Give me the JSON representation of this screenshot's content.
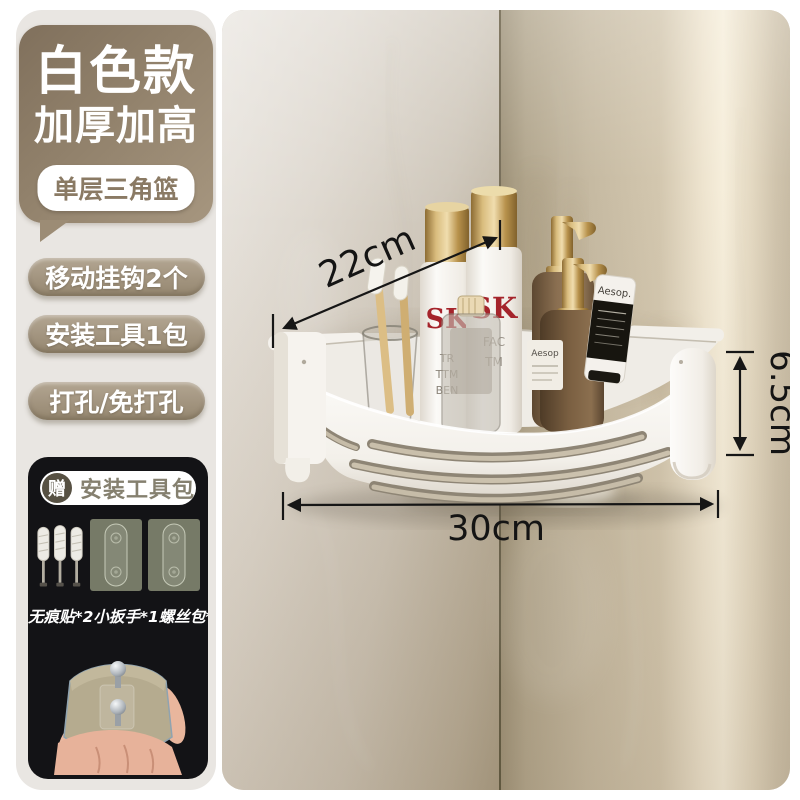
{
  "colors": {
    "bubble_brown": "#8f7e68",
    "pill_taupe": "#a89a85",
    "panel_dark": "#131316",
    "brand_red": "#a5242b",
    "gold": "#c59e55",
    "wall_highlight": "#f4ebd8",
    "arrow_black": "#161616"
  },
  "info_panel": {
    "title_line1": "白色款",
    "title_line2": "加厚加高",
    "variant_badge": "单层三角篮",
    "feature_pills": [
      {
        "label": "移动挂钩2个"
      },
      {
        "label": "安装工具1包"
      },
      {
        "label": "打孔/免打孔"
      }
    ],
    "gift_panel": {
      "badge": "赠",
      "title": "安装工具包",
      "contents_note": "无痕贴*2小扳手*1螺丝包*1"
    }
  },
  "photo": {
    "measurements": {
      "depth": "22cm",
      "height": "6.5cm",
      "width": "30cm"
    },
    "products": {
      "white_bottle_left_brand": "SK",
      "white_bottle_left_line1": "TR",
      "white_bottle_left_line2": "TTM",
      "white_bottle_left_line3": "BEN",
      "white_bottle_right_brand": "SK",
      "white_bottle_right_line1": "FAC",
      "white_bottle_right_line2": "TM",
      "amber_label": "Aesop",
      "tube_brand": "Aesop."
    }
  }
}
